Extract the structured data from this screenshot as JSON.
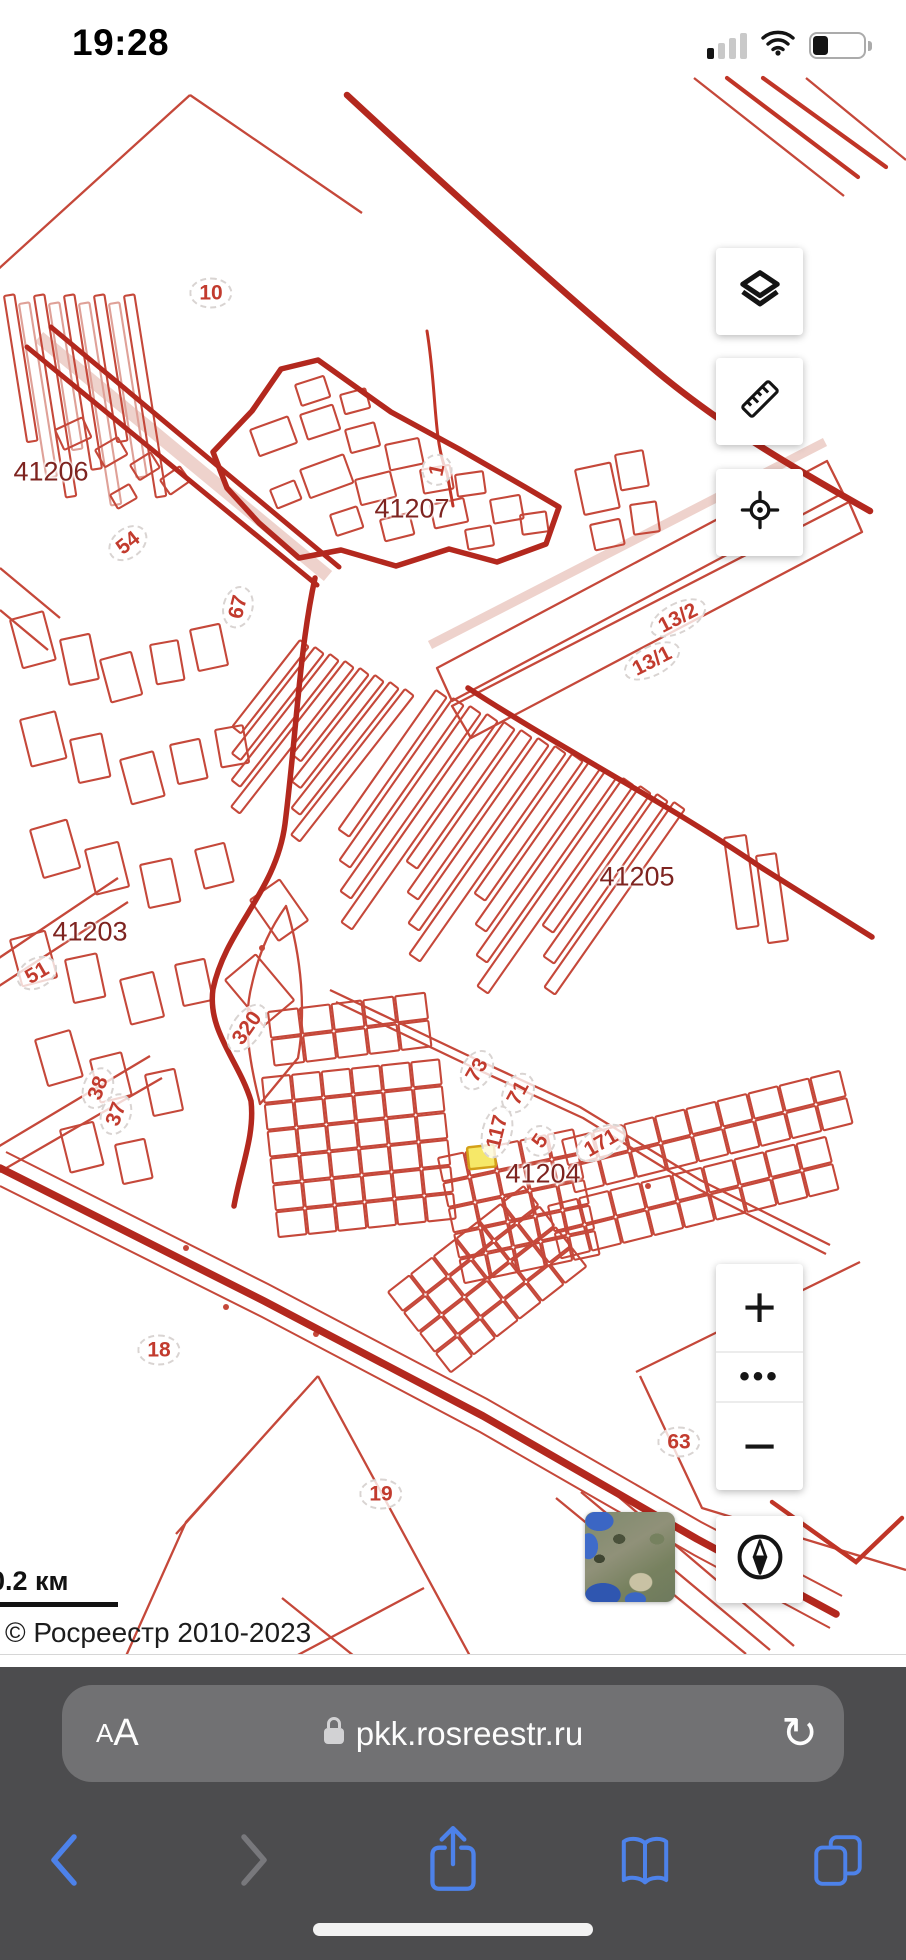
{
  "status_bar": {
    "time": "19:28"
  },
  "map": {
    "labels": [
      {
        "text": "10",
        "x": 211,
        "y": 293,
        "rot": 0,
        "kind": "parcel"
      },
      {
        "text": "41206",
        "x": 51,
        "y": 472,
        "rot": 0,
        "kind": "quarter"
      },
      {
        "text": "54",
        "x": 128,
        "y": 543,
        "rot": -38,
        "kind": "parcel"
      },
      {
        "text": "1",
        "x": 437,
        "y": 470,
        "rot": -78,
        "kind": "parcel"
      },
      {
        "text": "41207",
        "x": 412,
        "y": 509,
        "rot": 0,
        "kind": "quarter"
      },
      {
        "text": "13/2",
        "x": 678,
        "y": 618,
        "rot": -27,
        "kind": "parcel"
      },
      {
        "text": "13/1",
        "x": 652,
        "y": 661,
        "rot": -27,
        "kind": "parcel"
      },
      {
        "text": "67",
        "x": 238,
        "y": 607,
        "rot": -76,
        "kind": "parcel"
      },
      {
        "text": "41205",
        "x": 637,
        "y": 877,
        "rot": 0,
        "kind": "quarter"
      },
      {
        "text": "41203",
        "x": 90,
        "y": 932,
        "rot": 0,
        "kind": "quarter"
      },
      {
        "text": "51",
        "x": 37,
        "y": 973,
        "rot": -30,
        "kind": "parcel"
      },
      {
        "text": "320",
        "x": 247,
        "y": 1028,
        "rot": -55,
        "kind": "parcel"
      },
      {
        "text": "38",
        "x": 98,
        "y": 1088,
        "rot": -70,
        "kind": "parcel"
      },
      {
        "text": "37",
        "x": 116,
        "y": 1114,
        "rot": -70,
        "kind": "parcel"
      },
      {
        "text": "73",
        "x": 477,
        "y": 1070,
        "rot": -60,
        "kind": "parcel"
      },
      {
        "text": "71",
        "x": 518,
        "y": 1093,
        "rot": -62,
        "kind": "parcel"
      },
      {
        "text": "117",
        "x": 497,
        "y": 1132,
        "rot": -76,
        "kind": "parcel"
      },
      {
        "text": "5",
        "x": 540,
        "y": 1141,
        "rot": -55,
        "kind": "parcel"
      },
      {
        "text": "171",
        "x": 601,
        "y": 1143,
        "rot": -30,
        "kind": "parcel"
      },
      {
        "text": "41204",
        "x": 543,
        "y": 1174,
        "rot": 0,
        "kind": "quarter"
      },
      {
        "text": "18",
        "x": 159,
        "y": 1350,
        "rot": 0,
        "kind": "parcel"
      },
      {
        "text": "63",
        "x": 679,
        "y": 1442,
        "rot": 0,
        "kind": "parcel"
      },
      {
        "text": "19",
        "x": 381,
        "y": 1494,
        "rot": 0,
        "kind": "parcel"
      }
    ],
    "controls": {
      "zoom_in": "+",
      "zoom_more": "•••",
      "zoom_out": "−"
    },
    "scale_bar_label": "0.2 км",
    "copyright": "© Росреестр 2010-2023",
    "selected_parcel_color": "#f6e868"
  },
  "browser": {
    "reader_small": "A",
    "reader_large": "A",
    "url": "pkk.rosreestr.ru",
    "reload_glyph": "↻"
  },
  "colors": {
    "parcel_line": "#c5483a",
    "road_line": "#b3281e",
    "quarter_label": "#7e2420",
    "toolbar_bg": "#4c4c4e",
    "nav_blue": "#4d82ea"
  }
}
